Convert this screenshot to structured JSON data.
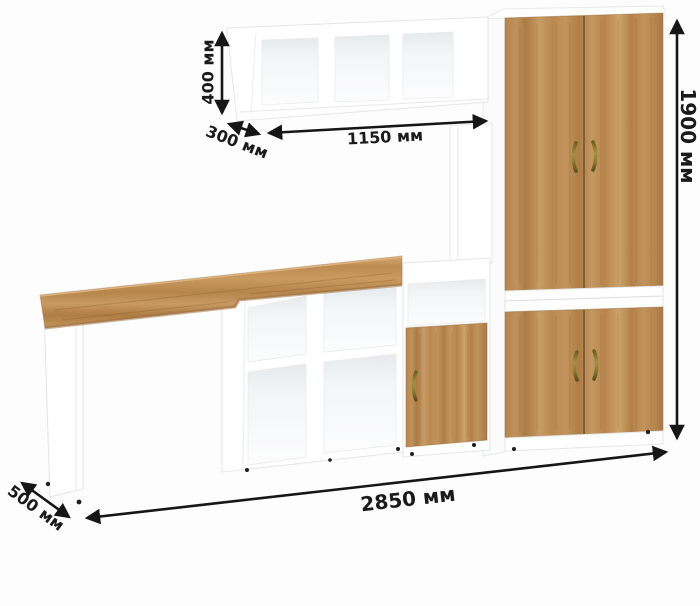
{
  "image": {
    "kind": "furniture dimension diagram",
    "background": "#fdfdfd"
  },
  "dimensions": {
    "wall_shelf_height": "400 мм",
    "wall_shelf_depth": "300 мм",
    "wall_shelf_width": "1150 мм",
    "cabinet_height": "1900 мм",
    "total_width": "2850 мм",
    "desk_depth": "500 мм"
  },
  "colors": {
    "wood": "#bf8d55",
    "wood_dark": "#9c7240",
    "panel_white": "#ffffff",
    "handle_brass": "#8a7a33",
    "dimension_lines": "#161616",
    "interior_shadow": "#e8eaec"
  }
}
